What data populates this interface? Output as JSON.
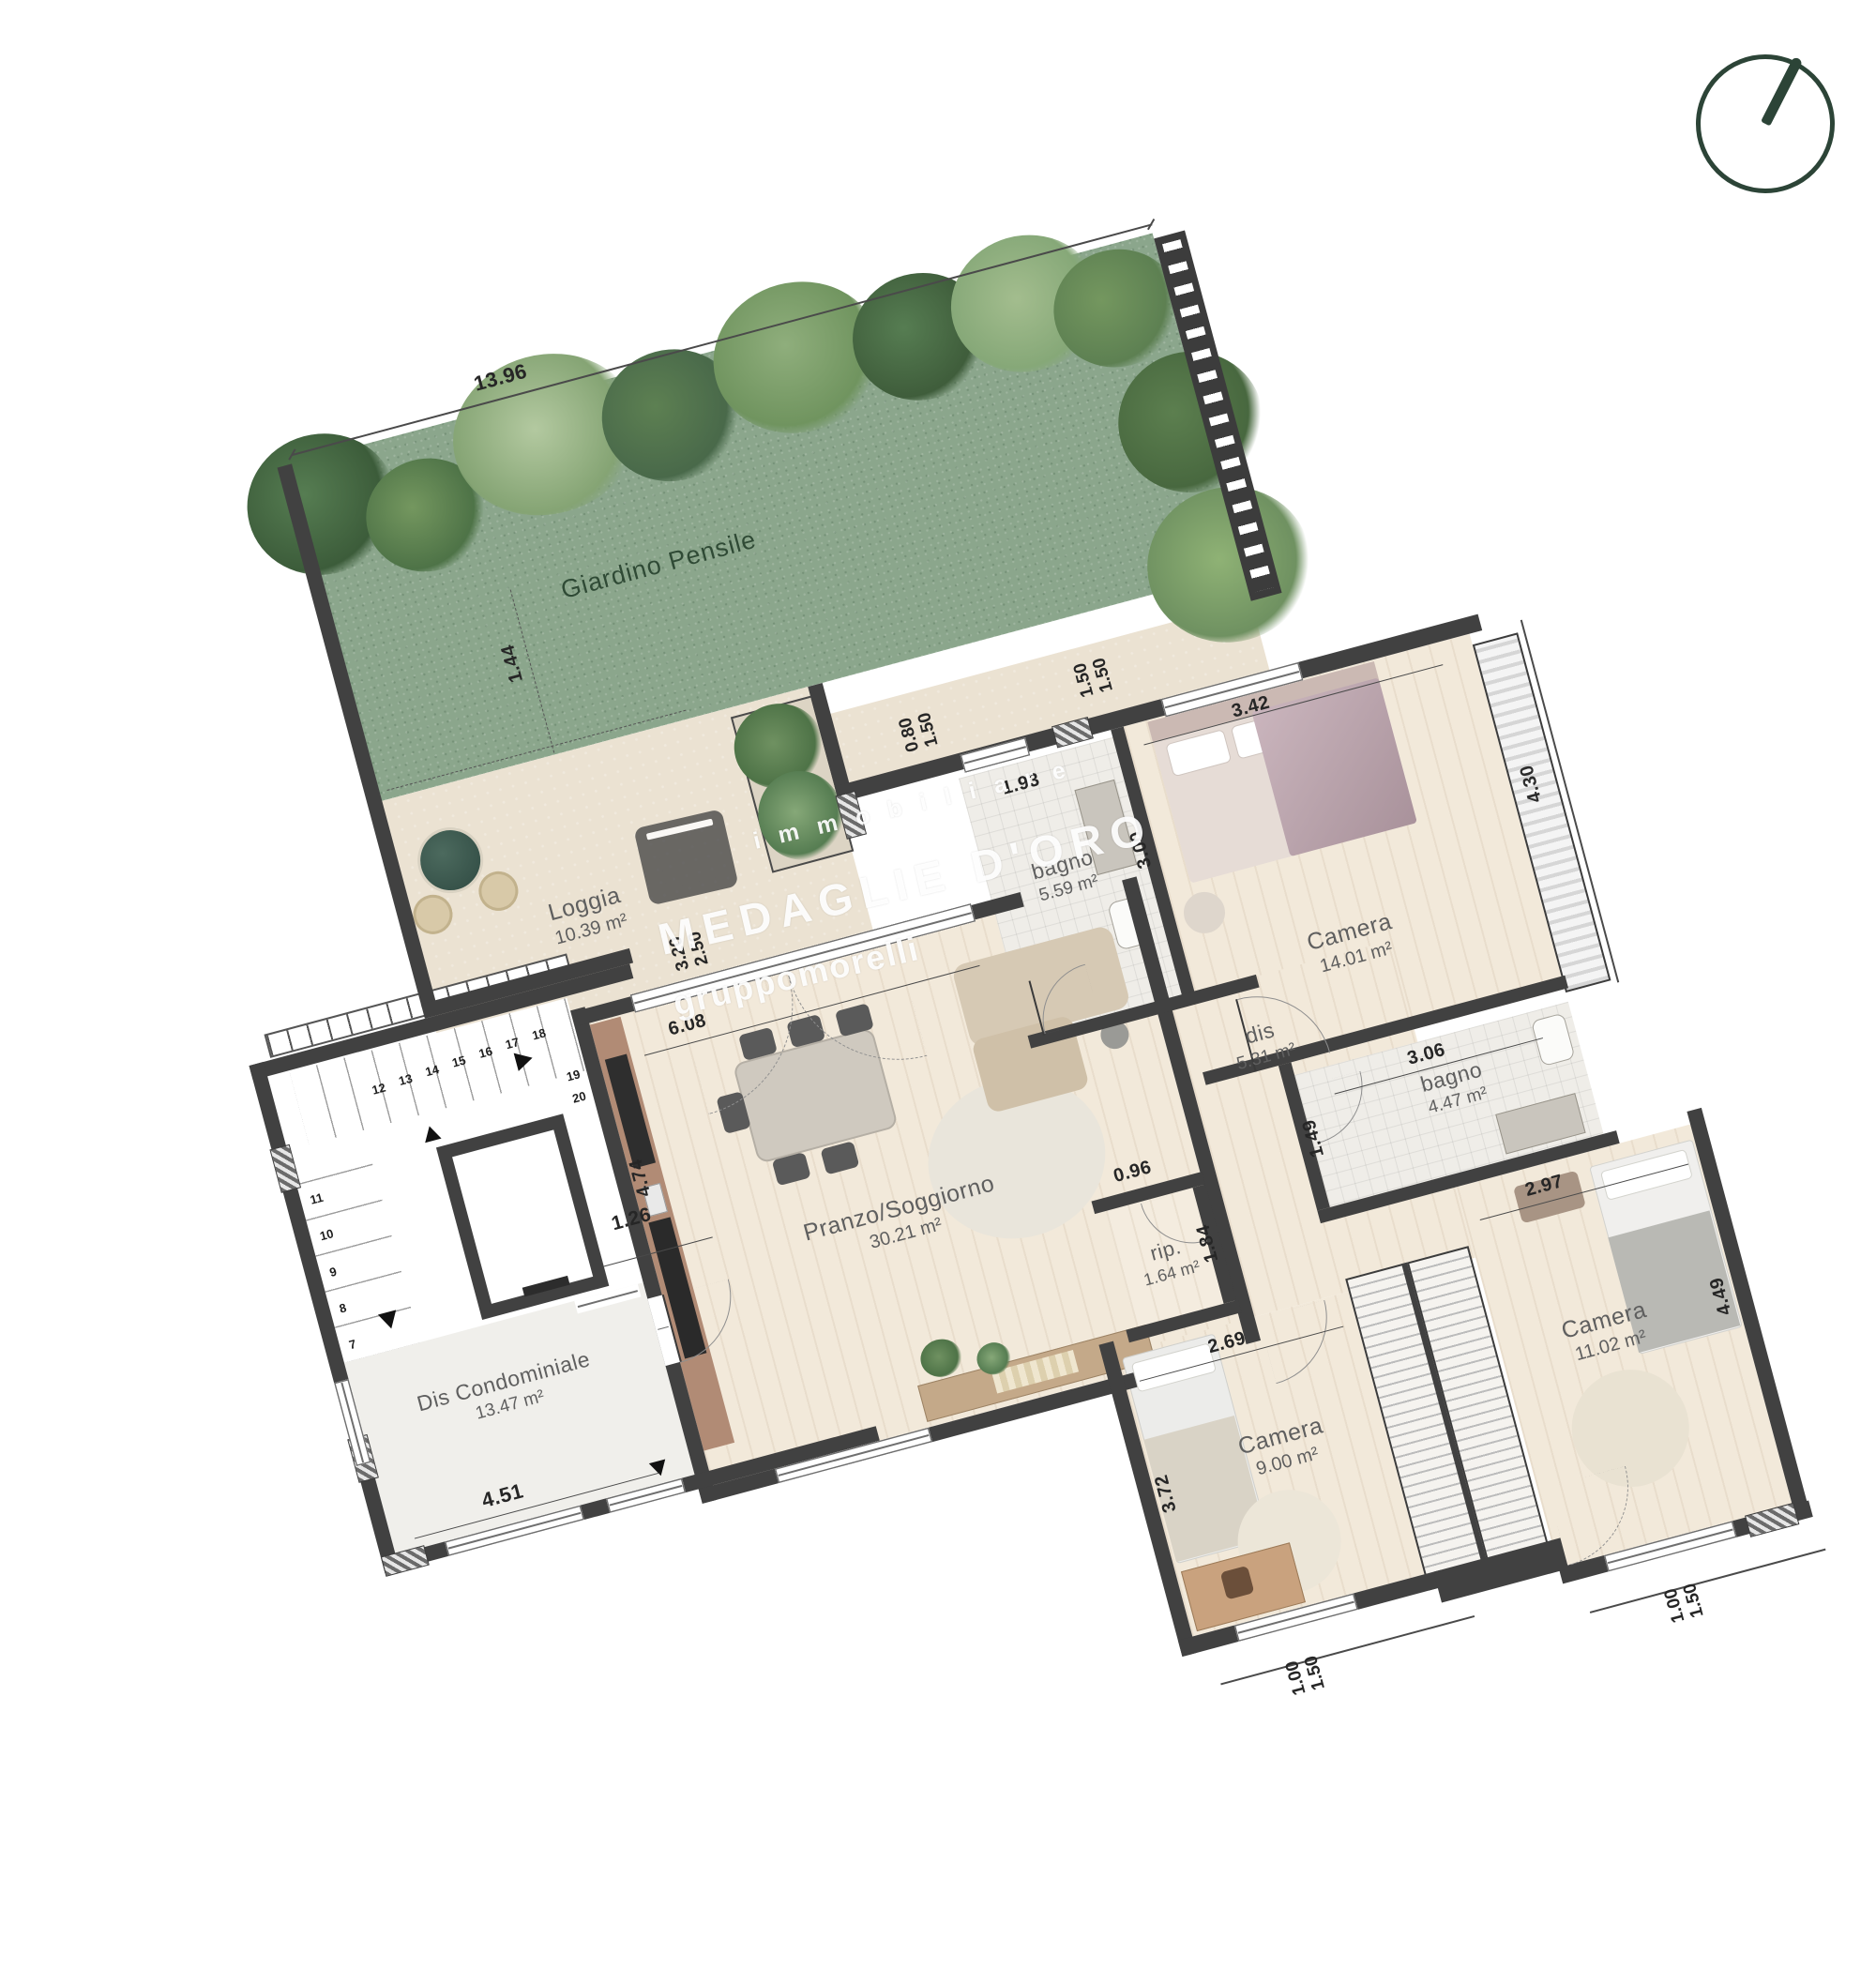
{
  "colors": {
    "accent_green": "#2c4437",
    "garden_green": "#8ba68c",
    "wall_dark": "#414141",
    "wood_floor": "#f2e9da",
    "stone_floor": "#ebe2d2"
  },
  "watermark": {
    "top": "immobiliare",
    "main": "MEDAGLIE D'ORO",
    "sub": "gruppomorelli"
  },
  "garden": {
    "label": "Giardino Pensile",
    "dim_top": "13.96",
    "dim_inner": "1.44"
  },
  "loggia": {
    "name": "Loggia",
    "area": "10.39 m²",
    "dim_a": "3.20",
    "dim_b": "2.50"
  },
  "living": {
    "name": "Pranzo/Soggiorno",
    "area": "30.21 m²",
    "dim_top": "6.08",
    "dim_left": "4.74"
  },
  "bagno1": {
    "name": "bagno",
    "area": "5.59 m²",
    "dim_top": "1.93",
    "dim_right": "3.00",
    "win": [
      "0.80",
      "1.50"
    ]
  },
  "camera1": {
    "name": "Camera",
    "area": "14.01 m²",
    "dim_top": "3.42",
    "dim_right": "4.30",
    "win": [
      "1.50",
      "1.50"
    ]
  },
  "dis": {
    "name": "dis",
    "area": "5.31 m²"
  },
  "bagno2": {
    "name": "bagno",
    "area": "4.47 m²",
    "dim_top": "3.06",
    "dim_left": "1.49"
  },
  "rip": {
    "name": "rip.",
    "area": "1.64 m²",
    "dim_top": "0.96",
    "dim_right": "1.84"
  },
  "camera2": {
    "name": "Camera",
    "area": "9.00 m²",
    "dim_top": "2.69",
    "dim_left": "3.72",
    "win": [
      "1.00",
      "1.50"
    ]
  },
  "camera3": {
    "name": "Camera",
    "area": "11.02 m²",
    "dim_top": "2.97",
    "dim_right": "4.49",
    "win": [
      "1.00",
      "1.50"
    ]
  },
  "condo": {
    "name": "Dis Condominiale",
    "area": "13.47 m²",
    "dim_bottom": "4.51",
    "dim_lift": "1.26"
  },
  "stairs": {
    "numbers": [
      "7",
      "8",
      "9",
      "10",
      "11",
      "12",
      "13",
      "14",
      "15",
      "16",
      "17",
      "18",
      "19",
      "20"
    ]
  }
}
